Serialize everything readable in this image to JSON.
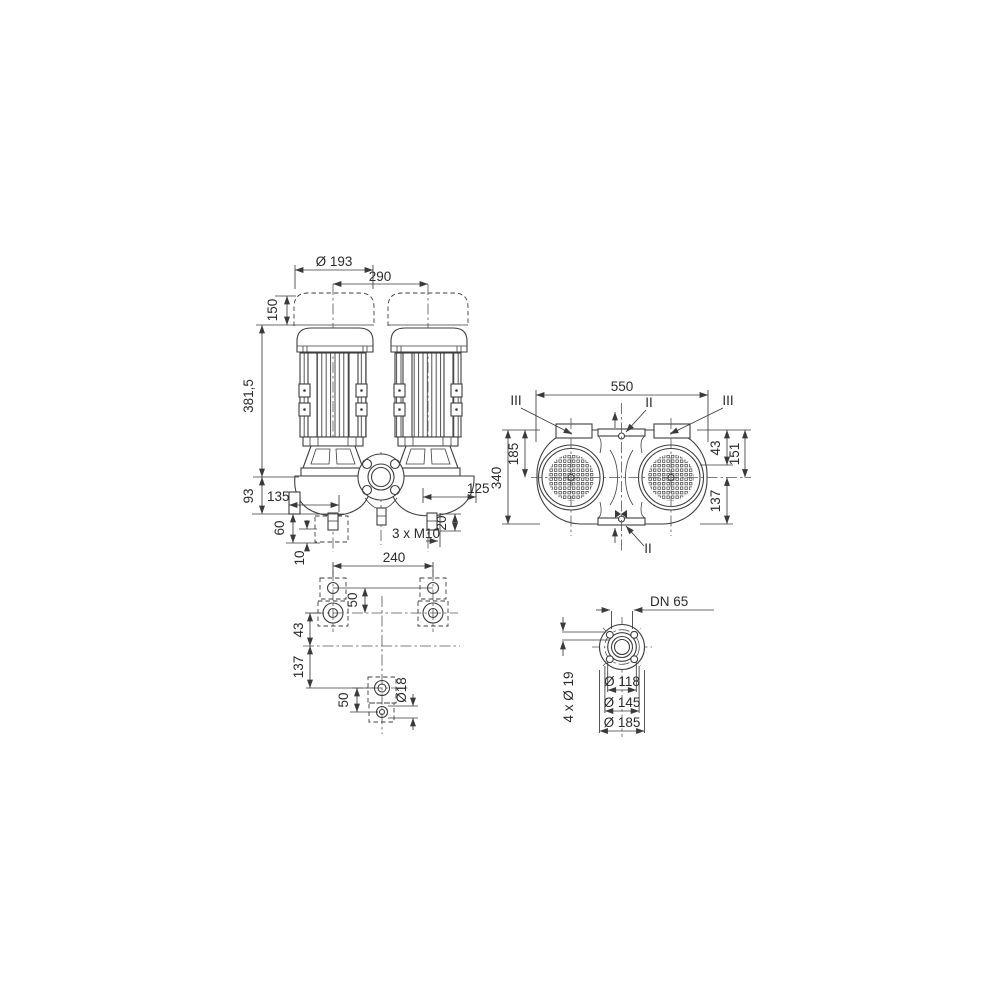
{
  "style": {
    "background": "#ffffff",
    "line_color": "#3e3e3e",
    "dimension_color": "#3a3a3a",
    "text_color": "#2b2b2b"
  },
  "front_view": {
    "dims": {
      "fan_diameter": "Ø 193",
      "pump_spacing": "290",
      "dismantling_clearance": "150",
      "height_above_axis": "381,5",
      "axis_to_base": "93",
      "foot_width": "135",
      "base_block_height": "60",
      "grout_thickness": "10",
      "axis_to_plug": "125",
      "plug_projection": "20",
      "foot_threads": "3 x M10"
    }
  },
  "plan_view": {
    "dims": {
      "overall_length": "550",
      "overall_width": "340",
      "edge_to_axis": "185",
      "edge_to_box": "43",
      "edge_to_center": "151",
      "center_to_edge": "137"
    },
    "marks": {
      "flange_section": "II",
      "motor_section": "III"
    }
  },
  "foundation_view": {
    "dims": {
      "bolt_spacing": "240",
      "hole_pair_spacing_top": "50",
      "axis_offset": "43",
      "axis_to_rear_bolt": "137",
      "hole_pair_spacing_bottom": "50",
      "bolt_hole_diameter": "Ø18"
    }
  },
  "flange_view": {
    "dims": {
      "nominal_bore": "DN 65",
      "bolt_holes": "4 x Ø 19",
      "raised_face_diameter": "Ø 118",
      "bolt_circle_diameter": "Ø 145",
      "flange_outer_diameter": "Ø 185"
    }
  }
}
